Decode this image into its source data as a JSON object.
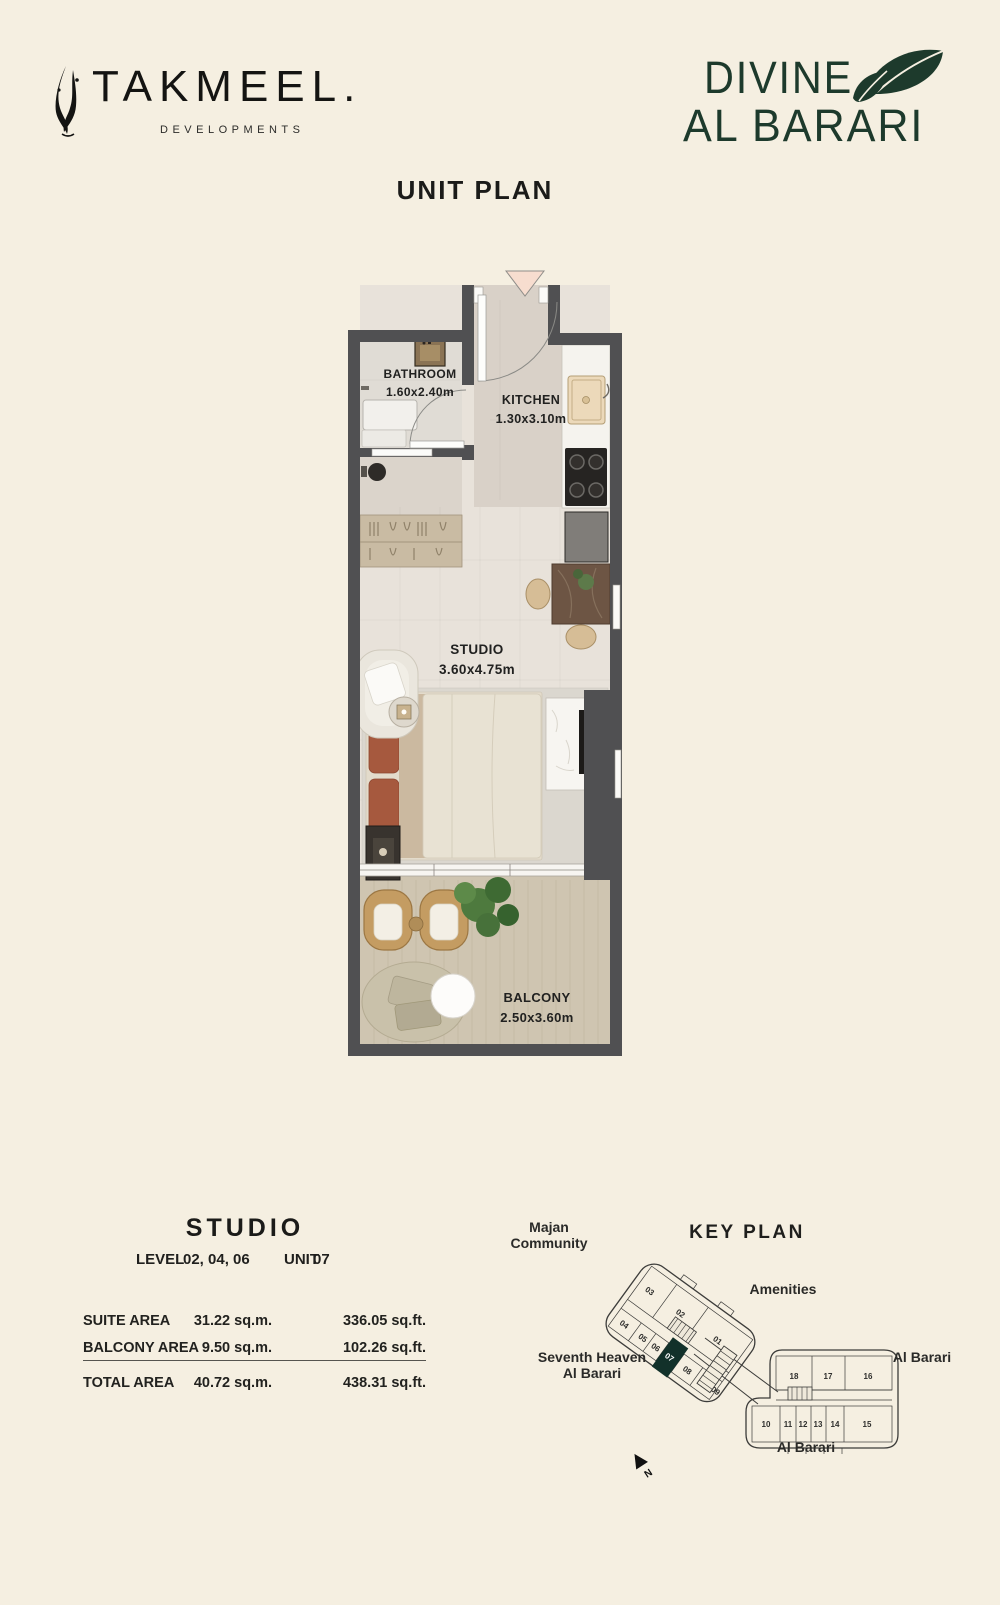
{
  "brand": {
    "takmeel_name": "TAKMEEL.",
    "takmeel_tagline": "DEVELOPMENTS",
    "divine_line1": "DIVINE",
    "divine_line2": "AL BARARI",
    "divine_color": "#1d3a2c"
  },
  "page_title": "UNIT PLAN",
  "floor_plan": {
    "rooms": [
      {
        "name": "BATHROOM",
        "dims": "1.60x2.40m"
      },
      {
        "name": "KITCHEN",
        "dims": "1.30x3.10m"
      },
      {
        "name": "STUDIO",
        "dims": "3.60x4.75m"
      },
      {
        "name": "BALCONY",
        "dims": "2.50x3.60m"
      }
    ],
    "colors": {
      "wall": "#505052",
      "studio_floor": "#e8e2da",
      "kitchen_floor": "#d9d1c8",
      "balcony_wood": "#cfc5b1",
      "entry_marker": "#f7ddcf"
    }
  },
  "unit_details": {
    "title": "STUDIO",
    "level_label": "LEVEL",
    "level_value": "02, 04, 06",
    "unit_label": "UNIT",
    "unit_value": "07",
    "areas": [
      {
        "label": "SUITE AREA",
        "sqm": "31.22 sq.m.",
        "sqft": "336.05 sq.ft."
      },
      {
        "label": "BALCONY AREA",
        "sqm": "9.50 sq.m.",
        "sqft": "102.26 sq.ft."
      },
      {
        "label": "TOTAL AREA",
        "sqm": "40.72 sq.m.",
        "sqft": "438.31 sq.ft."
      }
    ]
  },
  "key_plan": {
    "title": "KEY PLAN",
    "labels": {
      "majan": [
        "Majan",
        "Community"
      ],
      "amenities": "Amenities",
      "seventh_heaven": [
        "Seventh Heaven",
        "Al Barari"
      ],
      "al_barari_right": "Al Barari",
      "al_barari_bottom": "Al Barari"
    },
    "north": "N",
    "highlighted_unit": "07",
    "highlight_color": "#12312a",
    "left_wing_units": [
      "03",
      "02",
      "01",
      "04",
      "05",
      "06",
      "07",
      "08",
      "09"
    ],
    "right_wing_units": [
      "18",
      "17",
      "16",
      "10",
      "11",
      "12",
      "13",
      "14",
      "15"
    ]
  }
}
